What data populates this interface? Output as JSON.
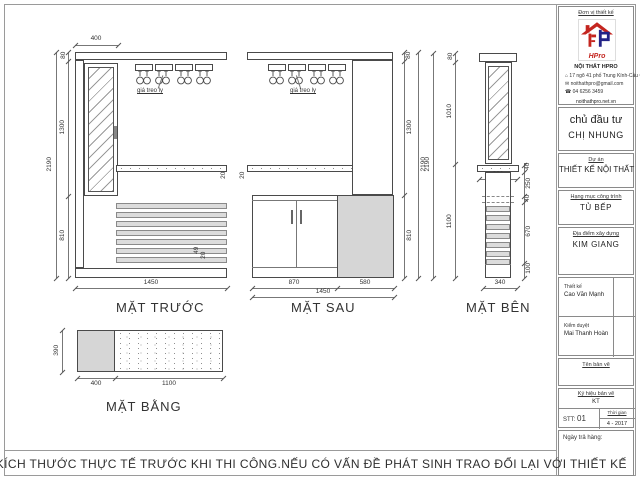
{
  "note": "KIỂM TRA KÍCH THƯỚC THỰC TẾ TRƯỚC KHI THI CÔNG.NẾU CÓ VẤN ĐỀ PHÁT SINH TRAO ĐỔI LẠI VỚI THIẾT KẾ",
  "views": {
    "front": {
      "label": "MẶT TRƯỚC",
      "rack_label": "giá treo ly",
      "dim_top_width": "400",
      "dim_total_height": "2190",
      "dim_upper_height": "1300",
      "dim_board_thick": "80",
      "dim_lower_height": "810",
      "dim_total_width": "1450",
      "dim_counter_thick": "20",
      "dim_slat_w": "49",
      "dim_slat_gap": "20"
    },
    "back": {
      "label": "MẶT SAU",
      "rack_label": "giá treo ly",
      "dim_board_thick": "80",
      "dim_upper_height": "1300",
      "dim_total_height": "2190",
      "dim_lower_height": "810",
      "dim_doors_width": "870",
      "dim_panel_width": "580",
      "dim_total_width": "1450",
      "dim_counter_thick": "20"
    },
    "side": {
      "label": "MẶT BÊN",
      "dim_board_thick": "80",
      "dim_upper_height": "1010",
      "dim_total_height": "2190",
      "dim_lower_height": "1100",
      "dim_counter_depth": "360",
      "dim_counter_thick": "40",
      "dim_gap": "250",
      "dim_shelf_thick": "40",
      "dim_slats_height": "670",
      "dim_plinth": "100",
      "dim_base_depth": "340"
    },
    "plan": {
      "label": "MẶT BẰNG",
      "dim_depth": "390",
      "dim_left": "400",
      "dim_right": "1100"
    }
  },
  "titleblock": {
    "designer_header": "Đơn vị thiết kế",
    "logo_text": "HPro",
    "company": "NỘI THẤT HPRO",
    "address": "17 ngõ 41 phố Trung Kính-Cầu Giấy-HN",
    "email": "noithathpro@gmail.com",
    "phone": "04 6256 3459",
    "website": "noithathpro.net.vn",
    "address_icon": "⌂",
    "email_icon": "✉",
    "phone_icon": "☎",
    "client_label": "chủ đầu tư",
    "client_name": "CHỊ NHUNG",
    "project_label": "Dự án",
    "project_name": "THIẾT KẾ NỘI THẤT",
    "category_label": "Hạng mục công trình",
    "category_name": "TỦ BẾP",
    "location_label": "Địa điểm xây dựng",
    "location_name": "KIM GIANG",
    "design_label": "Thiết kế",
    "designer_name": "Cao Văn Mạnh",
    "approve_label": "Kiểm duyệt",
    "approver_name": "Mai Thanh Hoàn",
    "drawing_name_label": "Tên bản vẽ",
    "drawing_code_label": "Ký hiệu bản vẽ",
    "drawing_code": "KT",
    "stt_label": "STT:",
    "stt_value": "01",
    "time_label": "Thời gian",
    "time_value": "4 - 2017",
    "delivery_label": "Ngày trả hàng:"
  },
  "colors": {
    "accent_red": "#c4251f",
    "accent_blue": "#232387",
    "panel_gray": "#d6d6d6",
    "line": "#4a4a4a"
  }
}
